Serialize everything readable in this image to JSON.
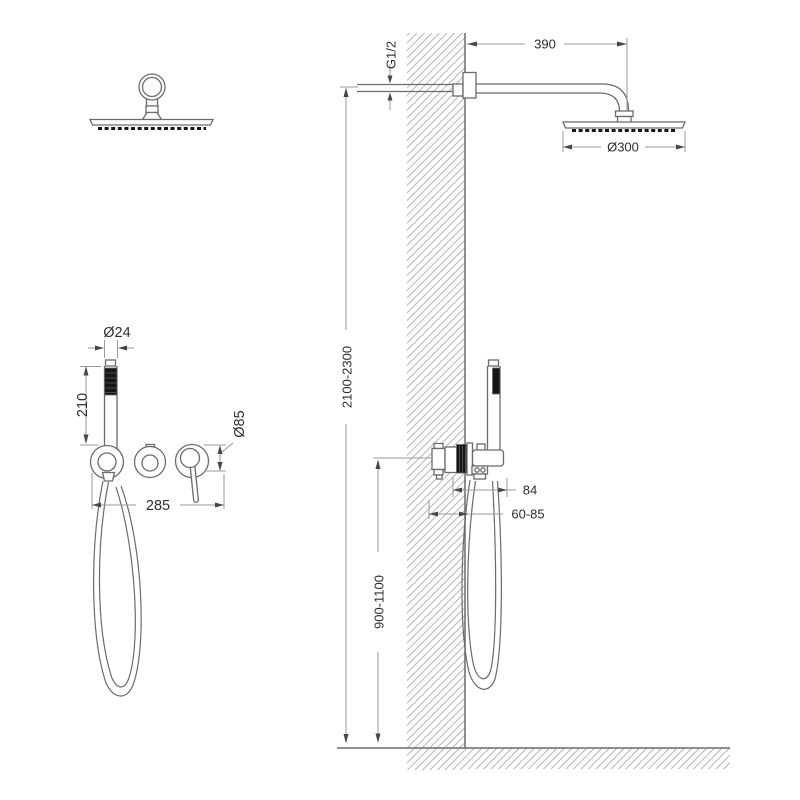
{
  "drawing": {
    "kind": "shower-system-installation-diagram",
    "dims": {
      "arm_length": "390",
      "thread_size": "G1/2",
      "head_diameter": "Ø300",
      "install_height": "2100-2300",
      "handle_diameter": "Ø24",
      "handle_length": "210",
      "trim_diameter": "Ø85",
      "trim_spacing": "285",
      "holder_offset": "84",
      "rough_in_depth": "60-85",
      "valve_height": "900-1100"
    },
    "colors": {
      "line": "#6b6b6b",
      "dim": "#9a9a9a",
      "text": "#2e2e2e",
      "dark": "#161616",
      "hatch": "#adadad",
      "bg": "#ffffff"
    }
  }
}
